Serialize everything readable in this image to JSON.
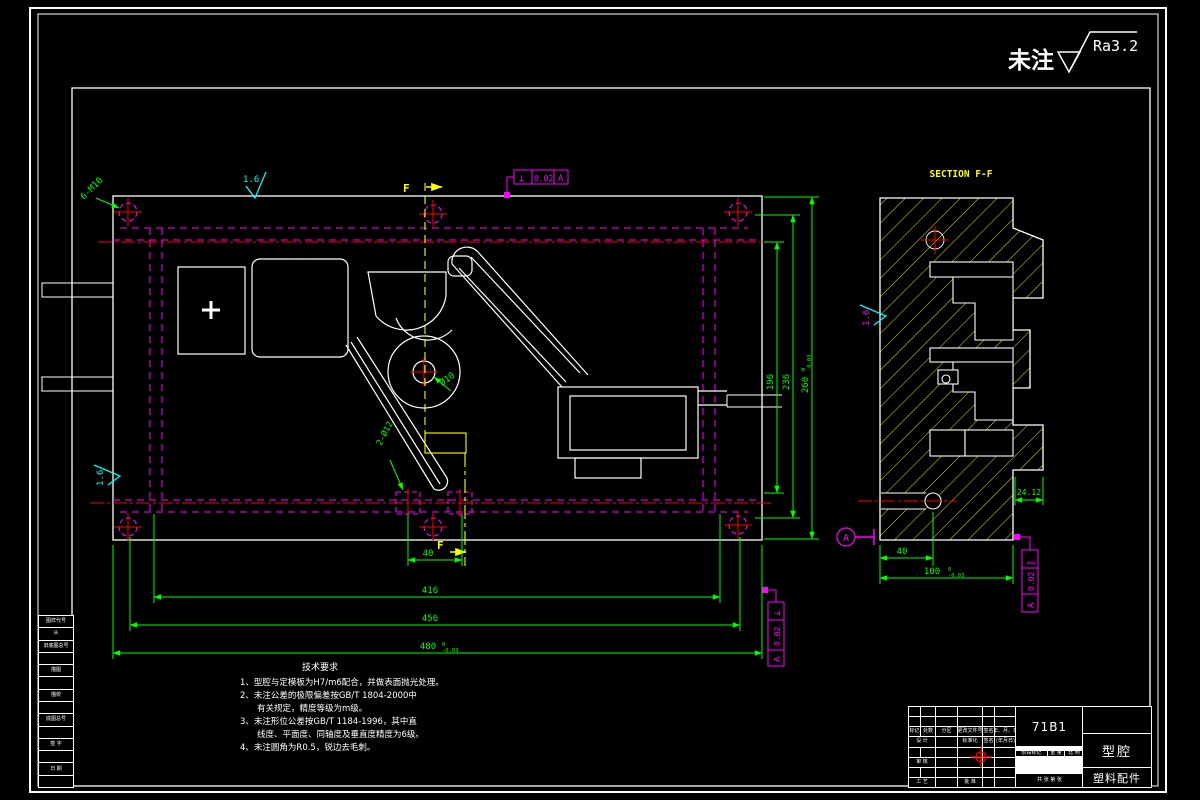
{
  "sheet": {
    "top_note": {
      "prefix": "未注",
      "roughness": "Ra3.2"
    }
  },
  "plan_view": {
    "labels": {
      "bolt_holes": "6-M10",
      "center_hole": "Ø10",
      "dowel_holes": "2-Ø12",
      "section_letter_top": "F",
      "section_letter_bottom": "F",
      "roughness_top": "1.6",
      "roughness_left": "1.6"
    },
    "fcf_top": {
      "symbol": "⊥",
      "tolerance": "0.02",
      "datum": "A"
    },
    "fcf_right": {
      "symbol": "⊥",
      "tolerance": "0.02",
      "datum": "A"
    },
    "dims": {
      "w40": "40",
      "w416": "416",
      "w456": "456",
      "w480": {
        "value": "480",
        "tol_upper": "0",
        "tol_lower": "-0.03"
      },
      "h196": "196",
      "h236": "236",
      "h260": {
        "value": "260",
        "tol_upper": "0",
        "tol_lower": "-0.03"
      }
    }
  },
  "section_view": {
    "title": "SECTION F-F",
    "datum_label": "A",
    "roughness_left": "1.6",
    "fcf": {
      "symbol": "∥",
      "tolerance": "0.02",
      "datum": "A"
    },
    "dims": {
      "w40": "40",
      "w100": {
        "value": "100",
        "tol_upper": "0",
        "tol_lower": "-0.03"
      },
      "w24": "24.12"
    }
  },
  "notes": {
    "title": "技术要求",
    "lines": [
      "1、型腔与定模板为H7/m6配合，并做表面抛光处理。",
      "2、未注公差的极限偏差按GB/T 1804-2000中",
      "　　有关规定，精度等级为m级。",
      "3、未注形位公差按GB/T 1184-1996，其中直",
      "　　线度、平面度、同轴度及垂直度精度为6级。",
      "4、未注圆角为R0.5，锐边去毛刺。"
    ]
  },
  "title_block": {
    "drawing_no": "71B1",
    "part_name": "型腔",
    "project_name": "塑料配件",
    "rev_headers": [
      "标记",
      "处数",
      "分区",
      "更改文件号",
      "签名",
      "年、月、日"
    ],
    "design_label": "设 计",
    "standard_label": "标准化",
    "sig_label": "(签名)",
    "date_label": "(年月日)",
    "check_label": "审 核",
    "process_label": "工 艺",
    "approve_label": "批 准",
    "stage_label": "阶段标记",
    "weight_label": "重 量",
    "scale_label": "比 例",
    "sheets_label": "共 张 第 张"
  },
  "margin_fields": [
    "图样代号",
    "从",
    "旧底图总号",
    "描图",
    "描校",
    "底图总号",
    "签 字",
    "日 期"
  ]
}
